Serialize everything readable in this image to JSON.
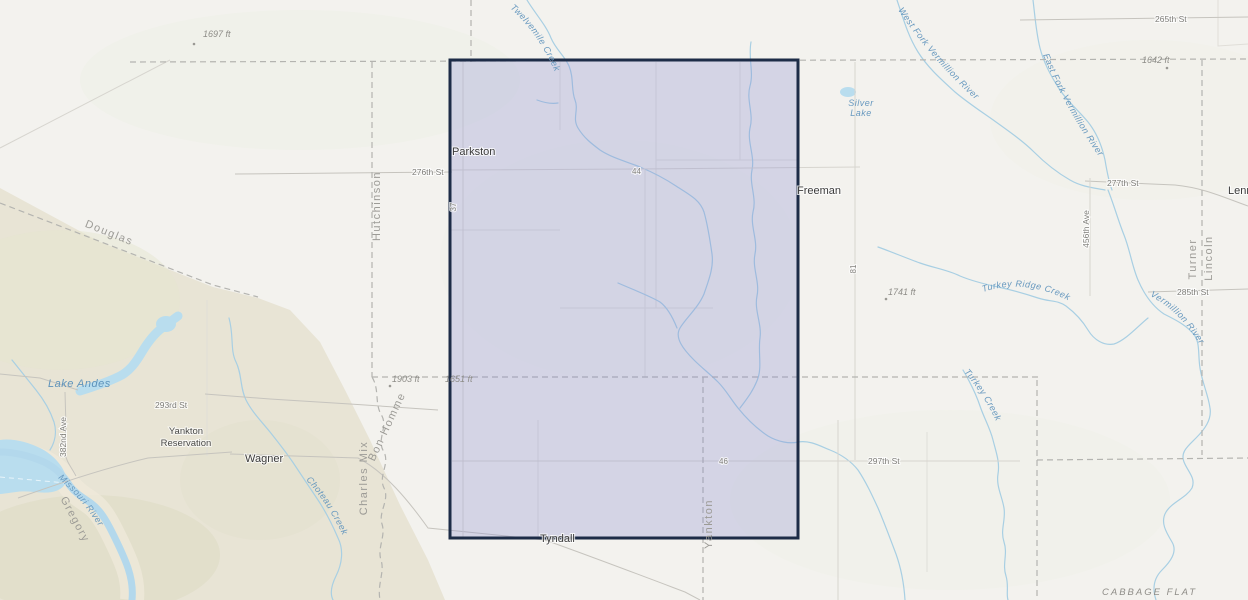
{
  "labels": {
    "cities": {
      "parkston": "Parkston",
      "freeman": "Freeman",
      "lennox": "Lennox",
      "wagner": "Wagner",
      "tyndall": "Tyndall"
    },
    "areas": {
      "yankton_reservation": [
        "Yankton",
        "Reservation"
      ],
      "cabbage_flat": "CABBAGE FLAT"
    },
    "counties": {
      "douglas": "Douglas",
      "hutchinson": "Hutchinson",
      "charles_mix": "Charles Mix",
      "bon_homme": "Bon Homme",
      "turner": "Turner",
      "lincoln": "Lincoln",
      "yankton": "Yankton",
      "gregory": "Gregory"
    },
    "water": {
      "twelvemile_creek": "Twelvemile Creek",
      "west_fork_vermillion": "West Fork Vermillion River",
      "east_fork_vermillion": "East Fork Vermillion River",
      "vermillion_river": "Vermillion River",
      "turkey_ridge_creek": "Turkey Ridge Creek",
      "turkey_creek": "Turkey Creek",
      "choteau_creek": "Choteau Creek",
      "missouri_river": "Missouri River",
      "lake_andes": "Lake Andes",
      "silver_lake": [
        "Silver",
        "Lake"
      ]
    },
    "roads": {
      "st265": "265th St",
      "st276": "276th St",
      "st277": "277th St",
      "st285": "285th St",
      "st293": "293rd St",
      "st297": "297th St",
      "ave456": "456th Ave",
      "ave382": "382nd Ave"
    },
    "highways": {
      "h44": "44",
      "h46": "46",
      "h37": "37",
      "h81": "81"
    },
    "elevations": {
      "e1697": "1697 ft",
      "e1642": "1642 ft",
      "e1741": "1741 ft",
      "e1903": "1903 ft",
      "e1651": "1651 ft"
    }
  },
  "selection_overlay": {
    "shape": "rectangle",
    "stroke_color": "#1d2c47",
    "fill_color": "rgba(134,136,210,0.28)"
  },
  "colors": {
    "background": "#f3f2ee",
    "terrain_west": "#e8e4d5",
    "water_fill": "#b9ddee",
    "water_line": "#a8cfe3",
    "road_line": "#c6c4be",
    "county_dash": "#b4b4b0",
    "city_label": "#3b3b3b",
    "county_label": "#9c9b96",
    "water_label": "#6899bf"
  }
}
